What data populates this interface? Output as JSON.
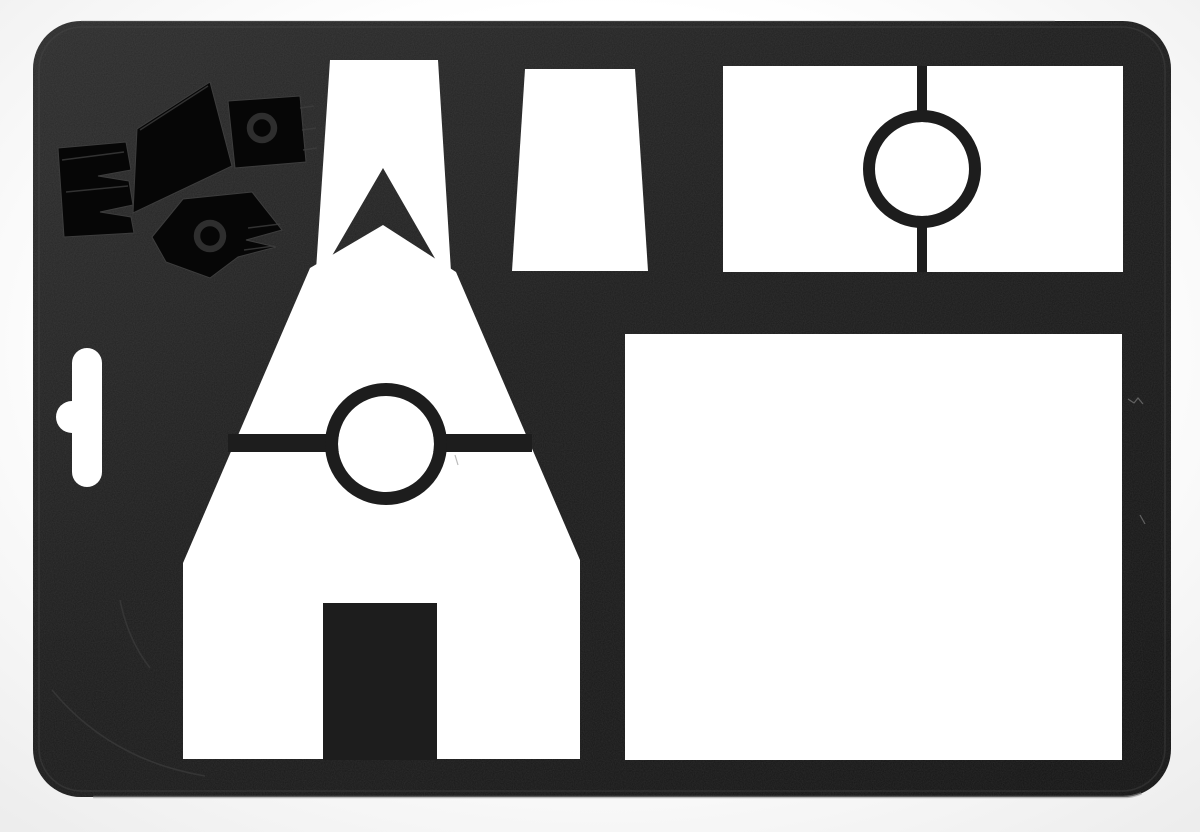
{
  "meta": {
    "title": "Photograph of a black molded-plastic drawing stencil sheet with punched-out white shapes: a tall-roofed house with circular window and door tab, a roof-peak chevron, a chimney trapezoid, a divided window rectangle with circle template, a large square, a hanging slot, and an embossed glossy brand emblem in the top-left corner",
    "canvas": {
      "width": 1200,
      "height": 832
    }
  },
  "colors": {
    "background": "#ffffff",
    "vignette": "#ededed",
    "plastic": "#1d1d1d",
    "plastic_highlight": "#2d2d2d",
    "plastic_shadow": "#141414",
    "bevel": "#4a4a4a",
    "edge_shine": "#8d8d8d",
    "cutout_white": "#ffffff",
    "logo_black": "#060606",
    "logo_ridge": "#3d3d3d",
    "logo_hole": "#2e2e2e",
    "mark_light": "#3a3a3a"
  },
  "object": {
    "kind": "black plastic stencil / template sheet on white background",
    "parts": [
      {
        "id": "stencil-sheet",
        "desc": "rounded-rectangle matte black plastic sheet"
      },
      {
        "id": "brand-emboss-logo",
        "desc": "glossy embossed emblem, top-left corner"
      },
      {
        "id": "hang-slot-cutout",
        "desc": "vertical hanging slot with round side notch, left edge"
      },
      {
        "id": "roof-peak-cutout",
        "desc": "tall gable outline cutout with black chevron inside, top center-left"
      },
      {
        "id": "house-cutout",
        "desc": "large house-shaped cutout with circle template on crossbar and door tab"
      },
      {
        "id": "chimney-cutout",
        "desc": "trapezoid cutout, top middle"
      },
      {
        "id": "window-cutout",
        "desc": "wide rectangle cutout split by thin bar with circle template, top right"
      },
      {
        "id": "square-cutout",
        "desc": "large square cutout, bottom right"
      }
    ]
  }
}
